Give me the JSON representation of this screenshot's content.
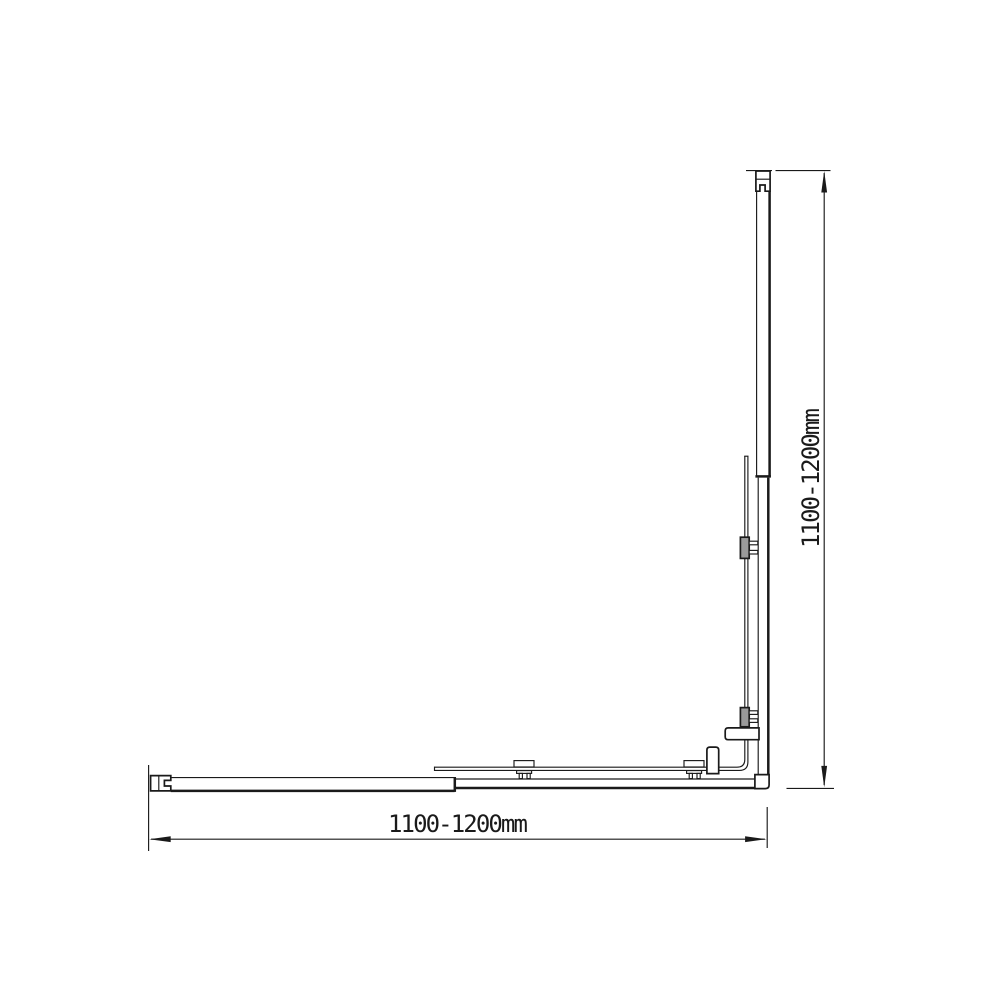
{
  "colors": {
    "background": "#ffffff",
    "line": "#1a1a1a",
    "clamp_fill": "#9a9a9a"
  },
  "dimensions": {
    "width_label": "1100-1200mm",
    "height_label": "1100-1200mm"
  }
}
